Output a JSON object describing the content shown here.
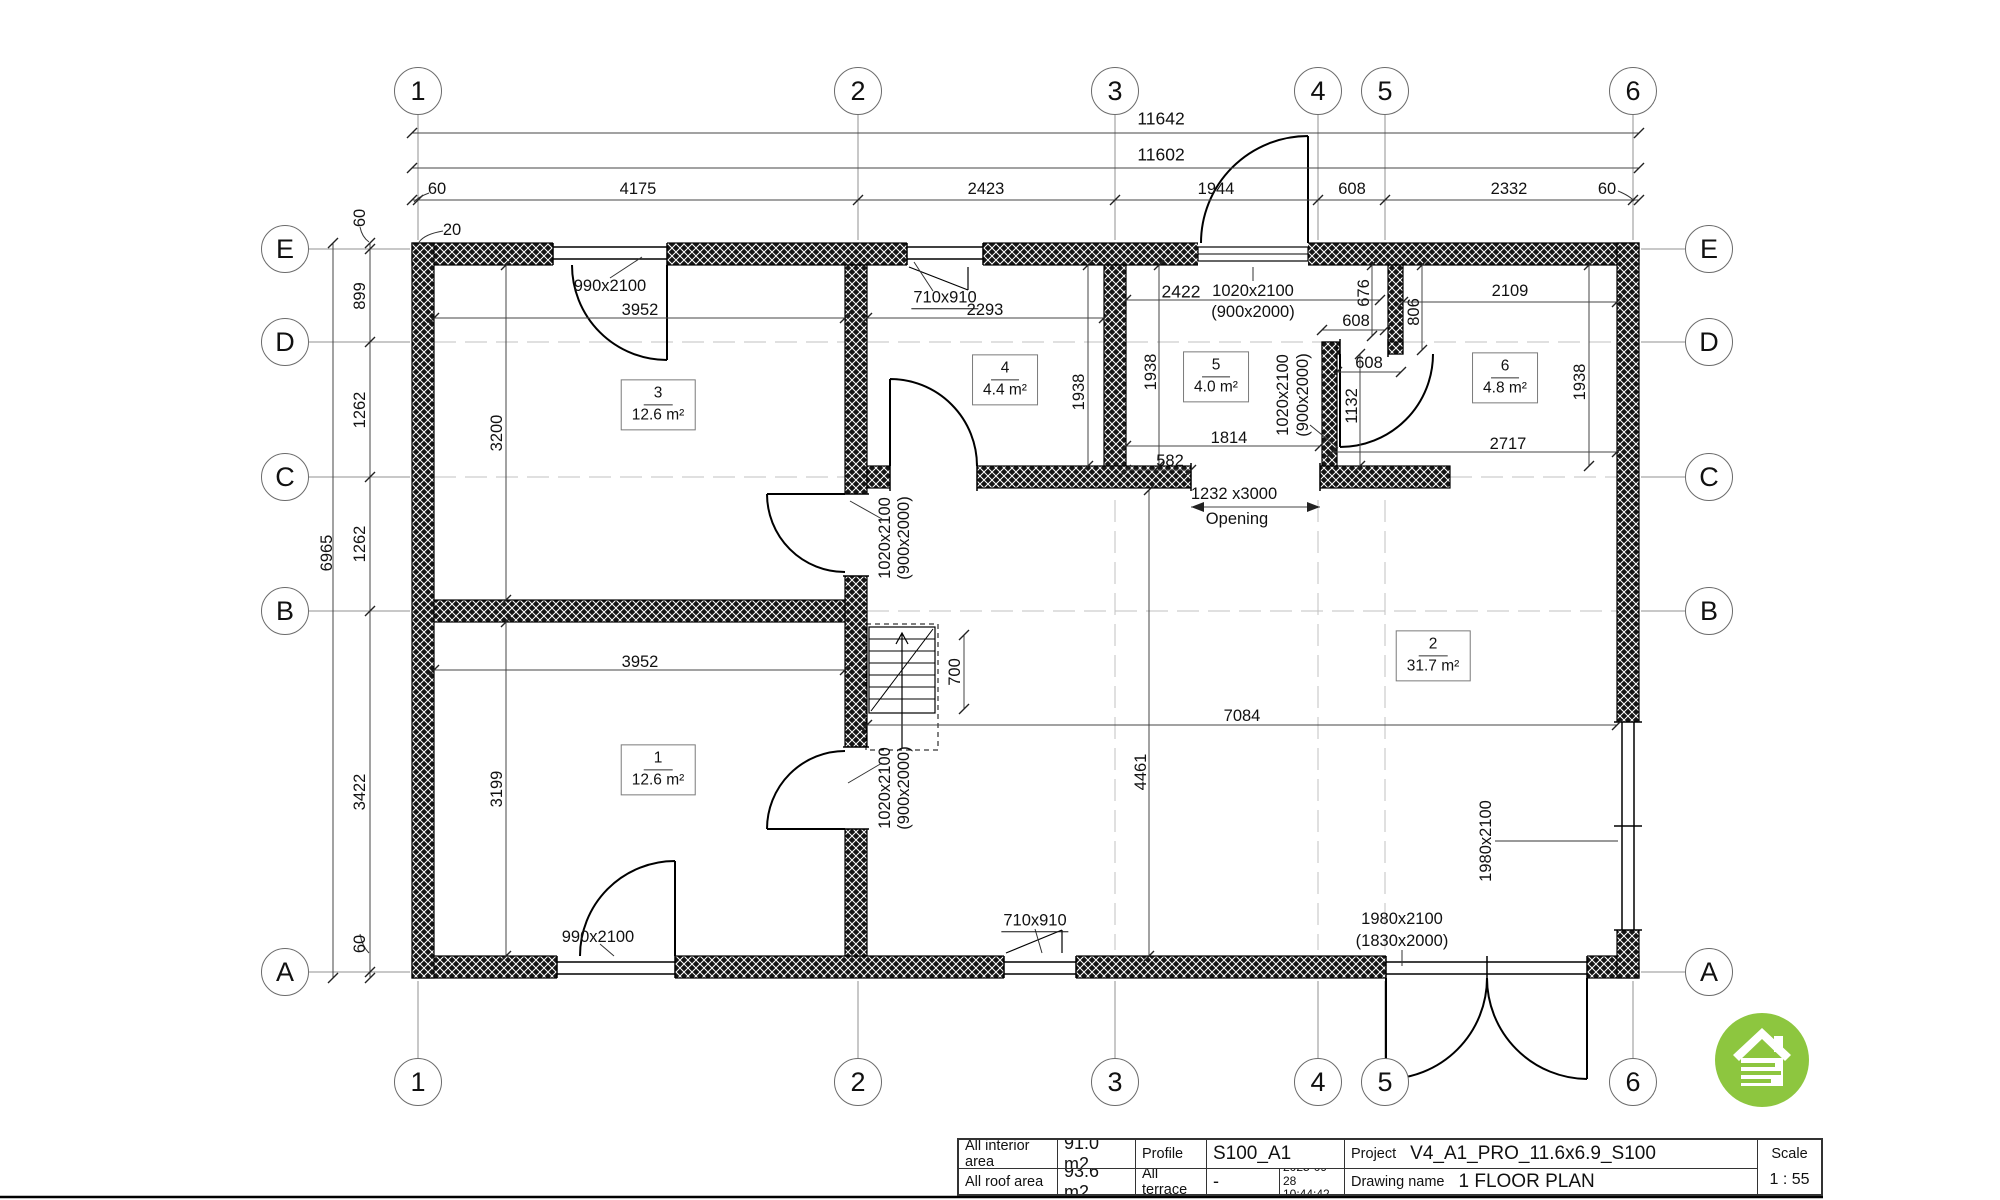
{
  "drawing": {
    "type": "architectural floor plan",
    "accent_green": "#8dc63f",
    "line_color": "#111111"
  },
  "grid": {
    "top_y": 91,
    "bottom_y": 1082,
    "left_x": 285,
    "right_x": 1709,
    "cols": [
      {
        "label": "1",
        "x": 418
      },
      {
        "label": "2",
        "x": 858
      },
      {
        "label": "3",
        "x": 1115
      },
      {
        "label": "4",
        "x": 1318
      },
      {
        "label": "5",
        "x": 1385
      },
      {
        "label": "6",
        "x": 1633
      }
    ],
    "rows": [
      {
        "label": "E",
        "y": 249
      },
      {
        "label": "D",
        "y": 342
      },
      {
        "label": "C",
        "y": 477
      },
      {
        "label": "B",
        "y": 611
      },
      {
        "label": "A",
        "y": 972
      }
    ]
  },
  "rooms": [
    {
      "num": "3",
      "area": "12.6 m²",
      "x": 658,
      "y": 405
    },
    {
      "num": "4",
      "area": "4.4 m²",
      "x": 1005,
      "y": 380
    },
    {
      "num": "5",
      "area": "4.0 m²",
      "x": 1216,
      "y": 377
    },
    {
      "num": "6",
      "area": "4.8 m²",
      "x": 1505,
      "y": 378
    },
    {
      "num": "1",
      "area": "12.6 m²",
      "x": 658,
      "y": 770
    },
    {
      "num": "2",
      "area": "31.7 m²",
      "x": 1433,
      "y": 656
    }
  ],
  "labels": [
    {
      "name": "dim-total-11642",
      "text": "11642",
      "x": 1161,
      "y": 119,
      "cls": "big"
    },
    {
      "name": "dim-total-11602",
      "text": "11602",
      "x": 1161,
      "y": 155,
      "cls": "big"
    },
    {
      "name": "dim-60-top-left",
      "text": "60",
      "x": 437,
      "y": 189
    },
    {
      "name": "dim-4175",
      "text": "4175",
      "x": 638,
      "y": 189
    },
    {
      "name": "dim-2423",
      "text": "2423",
      "x": 986,
      "y": 189
    },
    {
      "name": "dim-1944",
      "text": "1944",
      "x": 1216,
      "y": 189
    },
    {
      "name": "dim-608-top",
      "text": "608",
      "x": 1352,
      "y": 189
    },
    {
      "name": "dim-2332",
      "text": "2332",
      "x": 1509,
      "y": 189
    },
    {
      "name": "dim-60-top-right",
      "text": "60",
      "x": 1607,
      "y": 189
    },
    {
      "name": "dim-20",
      "text": "20",
      "x": 452,
      "y": 230
    },
    {
      "name": "dim-6965",
      "text": "6965",
      "x": 327,
      "y": 553,
      "rot": -90
    },
    {
      "name": "dim-60-left-top",
      "text": "60",
      "x": 360,
      "y": 218,
      "rot": -90
    },
    {
      "name": "dim-899",
      "text": "899",
      "x": 360,
      "y": 296,
      "rot": -90
    },
    {
      "name": "dim-1262-a",
      "text": "1262",
      "x": 360,
      "y": 410,
      "rot": -90
    },
    {
      "name": "dim-1262-b",
      "text": "1262",
      "x": 360,
      "y": 544,
      "rot": -90
    },
    {
      "name": "dim-3422",
      "text": "3422",
      "x": 360,
      "y": 792,
      "rot": -90
    },
    {
      "name": "dim-60-left-bottom",
      "text": "60",
      "x": 360,
      "y": 944,
      "rot": -90
    },
    {
      "name": "dim-3952-top",
      "text": "3952",
      "x": 640,
      "y": 310
    },
    {
      "name": "dim-2293",
      "text": "2293",
      "x": 985,
      "y": 310
    },
    {
      "name": "dim-2422",
      "text": "2422",
      "x": 1181,
      "y": 292,
      "cls": "big"
    },
    {
      "name": "dim-3200",
      "text": "3200",
      "x": 497,
      "y": 433,
      "rot": -90
    },
    {
      "name": "dim-1938-room4",
      "text": "1938",
      "x": 1079,
      "y": 392,
      "rot": -90
    },
    {
      "name": "dim-1938-room5",
      "text": "1938",
      "x": 1151,
      "y": 372,
      "rot": -90
    },
    {
      "name": "dim-1938-room6",
      "text": "1938",
      "x": 1580,
      "y": 382,
      "rot": -90
    },
    {
      "name": "dim-676",
      "text": "676",
      "x": 1364,
      "y": 293,
      "rot": -90
    },
    {
      "name": "dim-608-niche",
      "text": "608",
      "x": 1356,
      "y": 321
    },
    {
      "name": "dim-806",
      "text": "806",
      "x": 1414,
      "y": 312,
      "rot": -90
    },
    {
      "name": "dim-608-door",
      "text": "608",
      "x": 1369,
      "y": 363
    },
    {
      "name": "dim-2109",
      "text": "2109",
      "x": 1510,
      "y": 291
    },
    {
      "name": "dim-1132",
      "text": "1132",
      "x": 1352,
      "y": 406,
      "rot": -90
    },
    {
      "name": "dim-2717",
      "text": "2717",
      "x": 1508,
      "y": 444
    },
    {
      "name": "dim-1814",
      "text": "1814",
      "x": 1229,
      "y": 438
    },
    {
      "name": "dim-582",
      "text": "582",
      "x": 1170,
      "y": 461
    },
    {
      "name": "dim-opening-size",
      "text": "1232 x3000",
      "x": 1234,
      "y": 494
    },
    {
      "name": "opening-label",
      "text": "Opening",
      "x": 1237,
      "y": 519
    },
    {
      "name": "dim-3952-bottom",
      "text": "3952",
      "x": 640,
      "y": 662
    },
    {
      "name": "dim-700",
      "text": "700",
      "x": 955,
      "y": 672,
      "rot": -90
    },
    {
      "name": "dim-7084",
      "text": "7084",
      "x": 1242,
      "y": 716
    },
    {
      "name": "dim-4461",
      "text": "4461",
      "x": 1141,
      "y": 772,
      "rot": -90
    },
    {
      "name": "dim-3199",
      "text": "3199",
      "x": 497,
      "y": 789,
      "rot": -90
    },
    {
      "name": "door-990-top-label",
      "text": "990x2100",
      "x": 610,
      "y": 286
    },
    {
      "name": "window-710-top-label",
      "text": "710x910",
      "x": 945,
      "y": 299,
      "cls": "underline"
    },
    {
      "name": "door-entrance-size",
      "text": "1020x2100",
      "x": 1253,
      "y": 291
    },
    {
      "name": "door-entrance-size-2",
      "text": "(900x2000)",
      "x": 1253,
      "y": 312
    },
    {
      "name": "door-room3-size",
      "text": "1020x2100",
      "x": 885,
      "y": 538,
      "rot": -90
    },
    {
      "name": "door-room3-size-2",
      "text": "(900x2000)",
      "x": 904,
      "y": 538,
      "rot": -90
    },
    {
      "name": "door-room1-size",
      "text": "1020x2100",
      "x": 885,
      "y": 788,
      "rot": -90
    },
    {
      "name": "door-room1-size-2",
      "text": "(900x2000)",
      "x": 904,
      "y": 788,
      "rot": -90
    },
    {
      "name": "door-room6-size",
      "text": "1020x2100",
      "x": 1283,
      "y": 395,
      "rot": -90
    },
    {
      "name": "door-room6-size-2",
      "text": "(900x2000)",
      "x": 1303,
      "y": 395,
      "rot": -90
    },
    {
      "name": "door-990-bottom-label",
      "text": "990x2100",
      "x": 598,
      "y": 937
    },
    {
      "name": "window-710-bottom-label",
      "text": "710x910",
      "x": 1035,
      "y": 922,
      "cls": "underline"
    },
    {
      "name": "door-1980-label",
      "text": "1980x2100",
      "x": 1402,
      "y": 919
    },
    {
      "name": "door-1980-label-2",
      "text": "(1830x2000)",
      "x": 1402,
      "y": 941
    },
    {
      "name": "window-1980-right-label",
      "text": "1980x2100",
      "x": 1486,
      "y": 841,
      "rot": -90
    }
  ],
  "titleblock": {
    "interior_label": "All interior area",
    "interior_value": "91.0 m2",
    "roof_label": "All roof area",
    "roof_value": "93.6 m2",
    "profile_label": "Profile",
    "profile_value": "S100_A1",
    "terrace_label": "All terrace",
    "terrace_value": "-",
    "date_line1": "2025-09-28",
    "date_line2": "10:44:42",
    "project_label": "Project",
    "project_value": "V4_A1_PRO_11.6x6.9_S100",
    "drawing_label": "Drawing name",
    "drawing_value": "1 FLOOR PLAN",
    "scale_label": "Scale",
    "scale_value": "1 : 55"
  }
}
